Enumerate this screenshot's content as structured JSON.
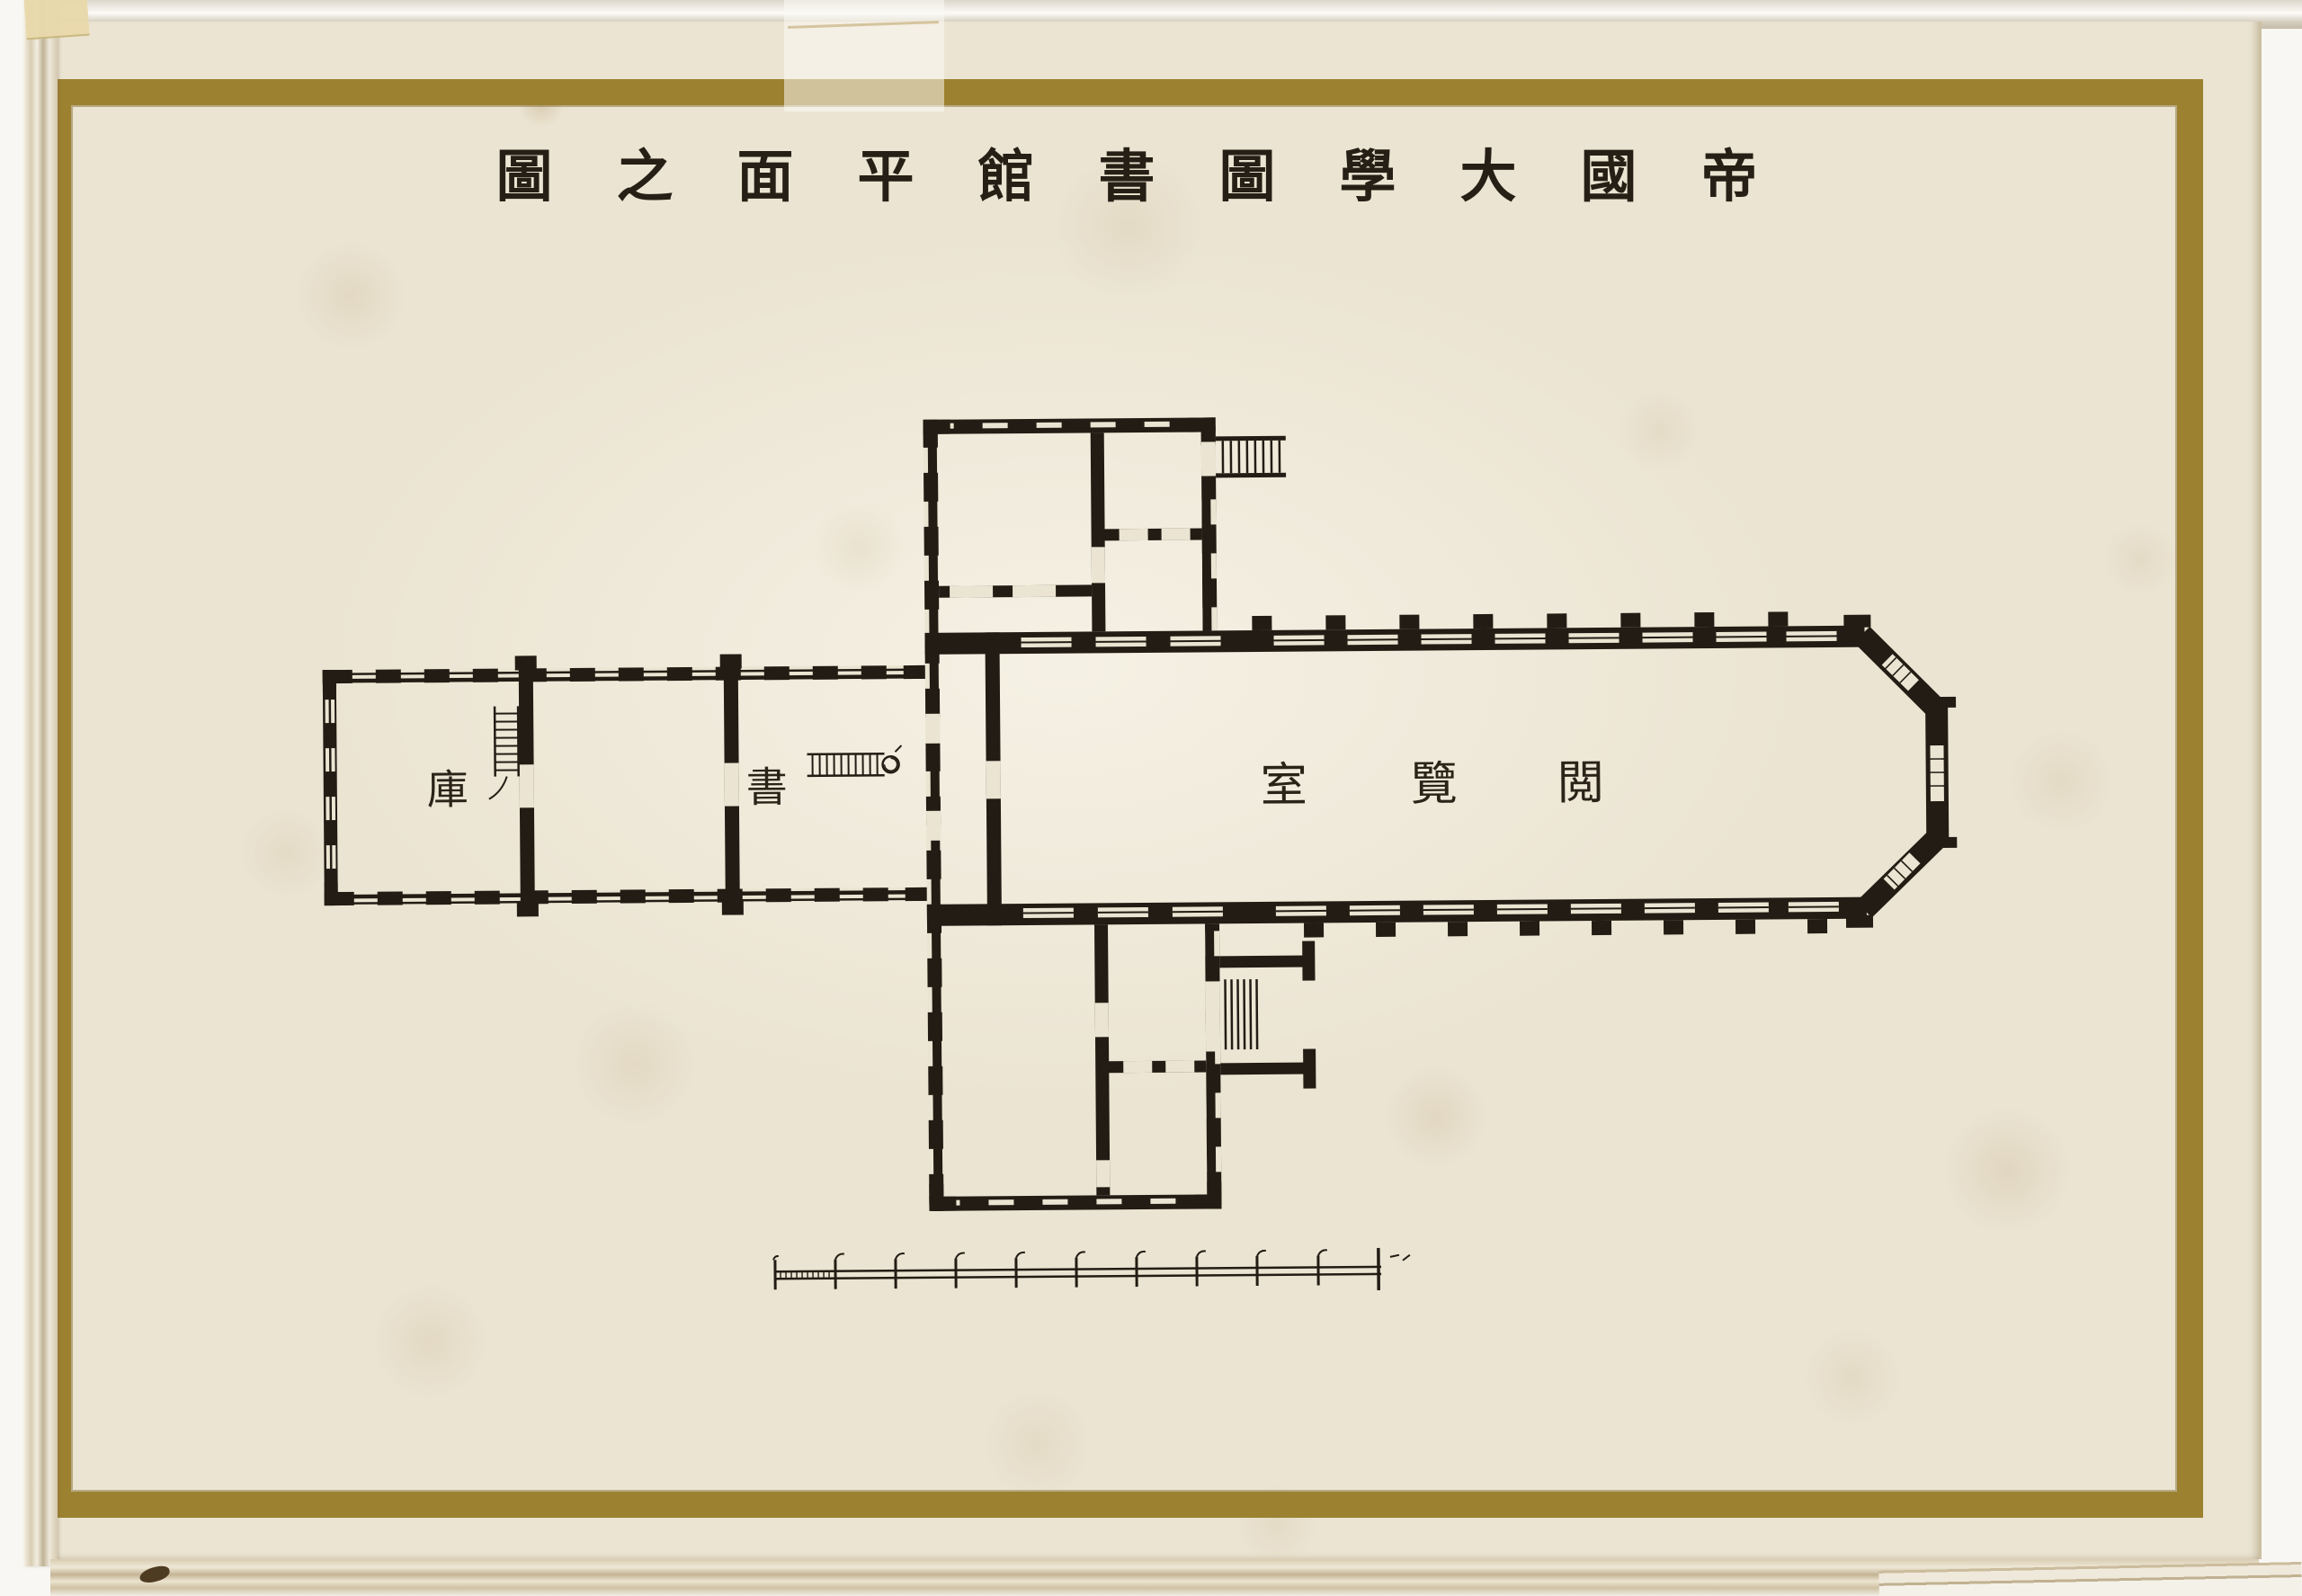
{
  "title": {
    "chars": [
      "圖",
      "之",
      "面",
      "平",
      "館",
      "書",
      "圖",
      "學",
      "大",
      "國",
      "帝"
    ],
    "reading_right_to_left": "帝國大學圖書館平面之圖"
  },
  "plan": {
    "reading_room": {
      "chars": [
        "室",
        "覽",
        "閲"
      ],
      "reading_right_to_left": "閲覽室"
    },
    "book_stack": {
      "west_room_char": "庫",
      "east_room_char": "書",
      "reading_right_to_left": "書庫"
    },
    "symbols": {
      "stairs": [
        "stack-west-staircase",
        "stack-east-staircase",
        "north-entrance-steps",
        "south-entrance-steps"
      ],
      "bay_end": "half-octagon-apse"
    }
  },
  "scale_bar": {
    "tick_count": 11,
    "first_segment_subdivided": true
  },
  "colors": {
    "ink": "#221c14",
    "paper": "#ebe4d2",
    "gold_frame": "#9c8130",
    "page_edge": "#cbbc9d",
    "background": "#f8f7f3"
  }
}
